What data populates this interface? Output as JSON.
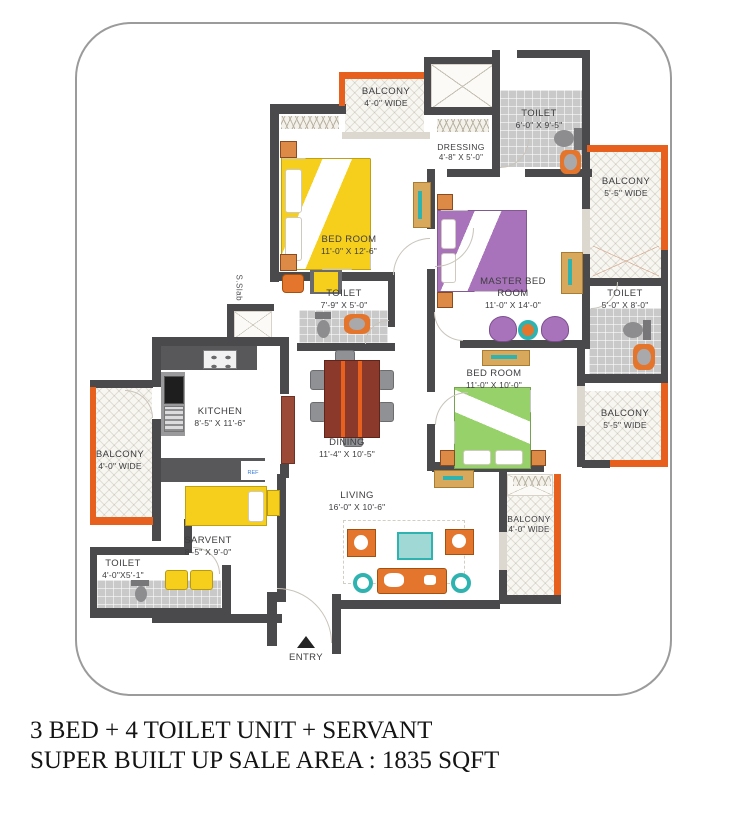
{
  "plan": {
    "rooms": {
      "balconyTop": {
        "name": "BALCONY",
        "dims": "4'-0\" WIDE"
      },
      "toiletTopRight": {
        "name": "TOILET",
        "dims": "6'-0\" X 9'-5\""
      },
      "dressing": {
        "name": "DRESSING",
        "dims": "4'-8\" X 5'-0\""
      },
      "bedroom1": {
        "name": "BED ROOM",
        "dims": "11'-0\" X 12'-6\""
      },
      "master": {
        "name": "MASTER BED ROOM",
        "dims": "11'-0\" X 14'-0\""
      },
      "balconyRightTop": {
        "name": "BALCONY",
        "dims": "5'-5\" WIDE"
      },
      "toiletRight": {
        "name": "TOILET",
        "dims": "5'-0\" X 8'-0\""
      },
      "toiletMid": {
        "name": "TOILET",
        "dims": "7'-9\" X 5'-0\""
      },
      "bedroom3": {
        "name": "BED ROOM",
        "dims": "11'-0\" X 10'-0\""
      },
      "balconyRightLow": {
        "name": "BALCONY",
        "dims": "5'-5\"  WIDE"
      },
      "kitchen": {
        "name": "KITCHEN",
        "dims": "8'-5\" X 11'-6\""
      },
      "dining": {
        "name": "DINING",
        "dims": "11'-4\" X 10'-5\""
      },
      "living": {
        "name": "LIVING",
        "dims": "16'-0\" X 10'-6\""
      },
      "balconyLeft": {
        "name": "BALCONY",
        "dims": "4'-0\"  WIDE"
      },
      "servant": {
        "name": "SARVENT",
        "dims": "8'-5\" X 9'-0\""
      },
      "toiletBottomLeft": {
        "name": "TOILET",
        "dims": "4'-0\"X5'-1\""
      },
      "balconyBottom": {
        "name": "BALCONY",
        "dims": "4'-0\" WIDE"
      }
    },
    "annotations": {
      "entry": "ENTRY",
      "sSlab": "S.Slab",
      "ref": "REF"
    },
    "colors": {
      "wall": "#4a4a4c",
      "accent": "#e7601d",
      "bed1": "#f6cf1d",
      "bedMaster": "#a873ba",
      "bed3": "#96d169"
    }
  },
  "caption": {
    "line1": "3 BED + 4 TOILET UNIT + SERVANT",
    "line2": "SUPER BUILT UP SALE AREA : 1835 SQFT"
  }
}
